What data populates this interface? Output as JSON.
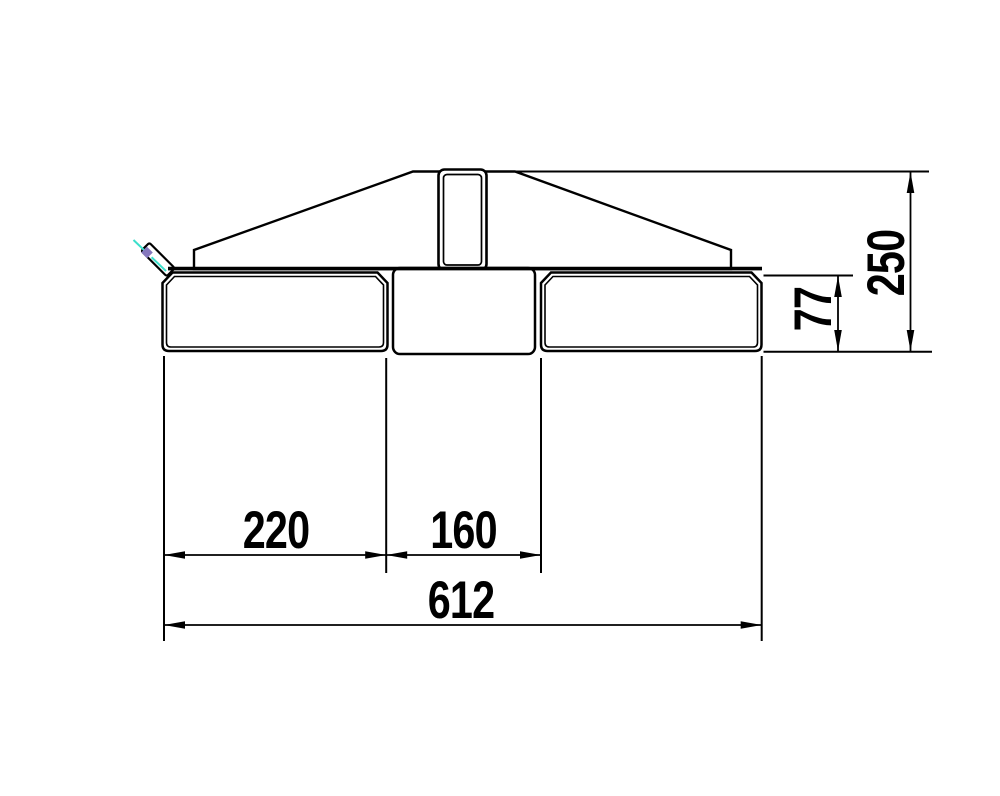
{
  "drawing": {
    "dimensions": {
      "left_pocket_width": "220",
      "center_section_width": "160",
      "overall_width": "612",
      "pocket_height": "77",
      "overall_height": "250"
    },
    "colors": {
      "line": "#000000",
      "background": "#ffffff",
      "pin_centerline": "#3cdfcb",
      "pin_cap": "#8577bd"
    }
  }
}
